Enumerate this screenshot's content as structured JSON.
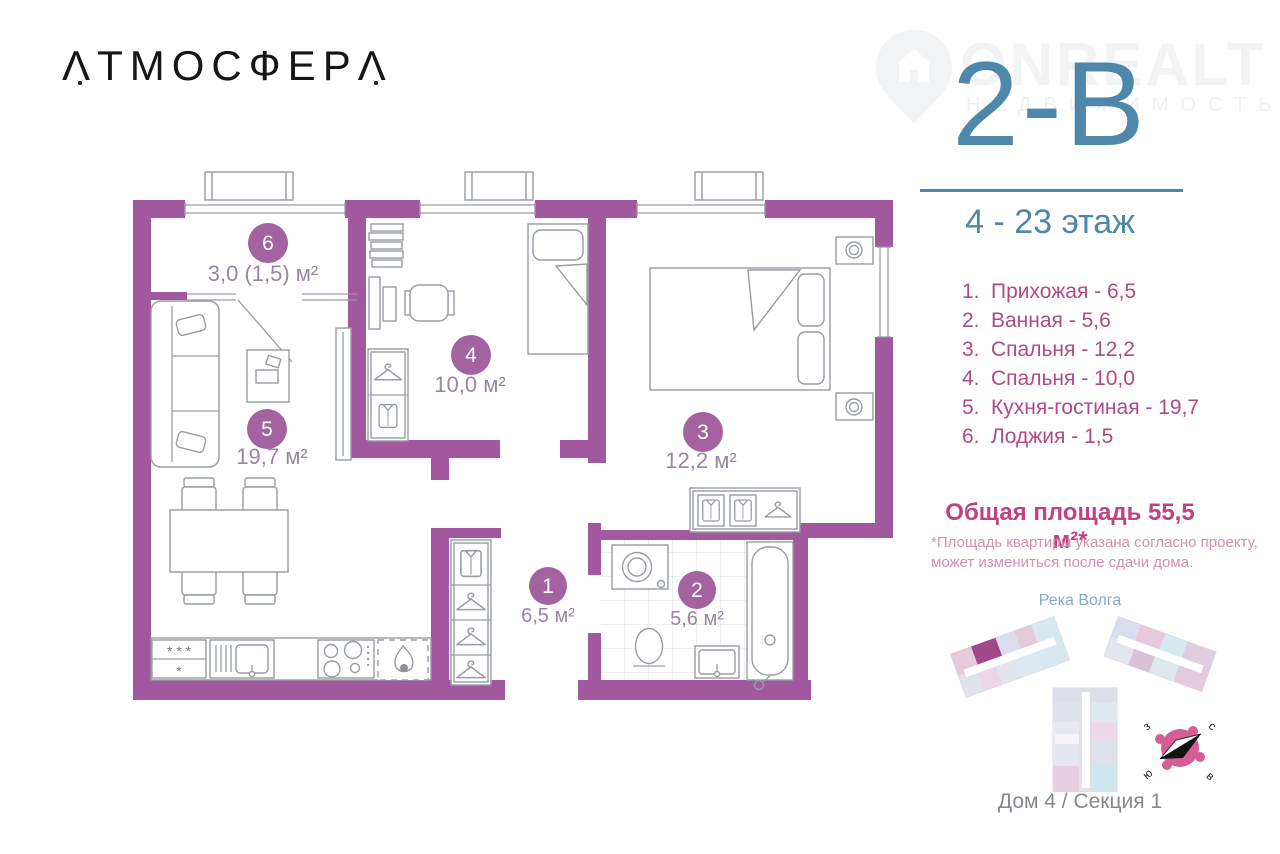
{
  "logo": {
    "text": "АТМОСФЕРА"
  },
  "header": {
    "plan_code": "2-В",
    "floors": "4 - 23 этаж",
    "watermark": {
      "brand": "ONREALT",
      "tagline": "НЕДВИЖИМОСТЬ"
    }
  },
  "room_list": {
    "items": [
      {
        "num": "1.",
        "text": "Прихожая - 6,5"
      },
      {
        "num": "2.",
        "text": "Ванная - 5,6"
      },
      {
        "num": "3.",
        "text": "Спальня - 12,2"
      },
      {
        "num": "4.",
        "text": "Спальня - 10,0"
      },
      {
        "num": "5.",
        "text": "Кухня-гостиная - 19,7"
      },
      {
        "num": "6.",
        "text": "Лоджия - 1,5"
      }
    ]
  },
  "summary": {
    "total_area": "Общая площадь 55,5 м²*",
    "footnote_line1": "*Площадь квартиры указана согласно проекту,",
    "footnote_line2": "может измениться после сдачи дома."
  },
  "site": {
    "river": "Река Волга",
    "caption": "Дом 4 / Секция 1",
    "compass": {
      "north": "с",
      "south": "ю",
      "west": "з",
      "east": "в"
    }
  },
  "plan": {
    "labels": [
      {
        "num": "1",
        "area": "6,5 м²"
      },
      {
        "num": "2",
        "area": "5,6 м²"
      },
      {
        "num": "3",
        "area": "12,2 м²"
      },
      {
        "num": "4",
        "area": "10,0 м²"
      },
      {
        "num": "5",
        "area": "19,7 м²"
      },
      {
        "num": "6",
        "area": "3,0 (1,5) м²"
      }
    ],
    "fridge_marks": {
      "top": "* * *",
      "bottom": "*"
    }
  },
  "colors": {
    "wall_purple": "#a1589e",
    "accent_blue": "#4e87a9",
    "list_pink": "#b04b82",
    "heading_pink": "#c24180",
    "footnote_pink": "#d38fb0",
    "circle_purple": "#a263a0",
    "site_highlight": "#a24787",
    "compass_pink": "#d45f95"
  }
}
